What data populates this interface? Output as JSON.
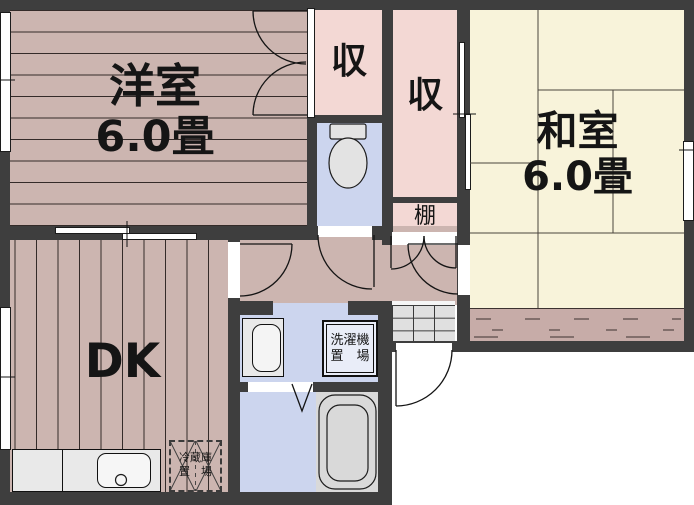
{
  "plan": {
    "rooms": {
      "western_room": {
        "name": "洋室",
        "size": "6.0畳"
      },
      "japanese_room": {
        "name": "和室",
        "size": "6.0畳"
      },
      "dining_kitchen": {
        "name": "DK"
      },
      "closet_upper": {
        "name": "収"
      },
      "closet_side": {
        "name": "収"
      },
      "shelf": {
        "name": "棚"
      },
      "washing_machine_space": {
        "line1": "洗濯機",
        "line2": "置　場"
      },
      "refrigerator_space": {
        "line1": "冷蔵庫",
        "line2": "置　場"
      }
    },
    "colors": {
      "wall": "#3e3e3e",
      "wood_floor": "#ccb5b0",
      "closet_pink": "#f3d8d4",
      "tatami_cream": "#f8f3da",
      "wet_area_blue": "#ccd5ee",
      "fixture_gray": "#dcdcdc"
    }
  }
}
